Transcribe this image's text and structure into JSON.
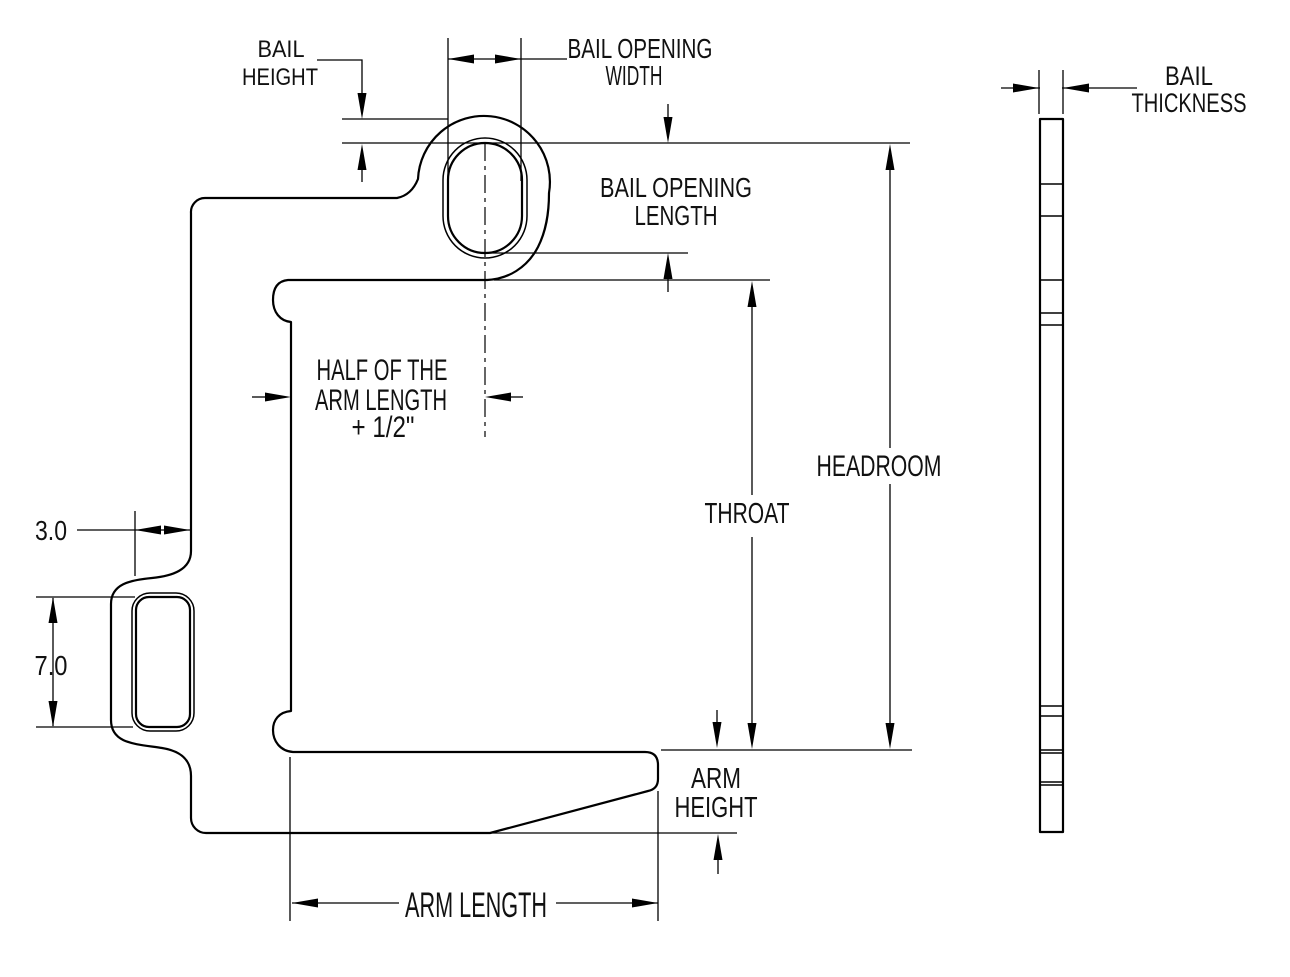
{
  "drawing": {
    "type": "engineering-dimension-diagram",
    "subject": "Coil C-hook lifting device - front profile with bail and fork pocket, plus bail side profile",
    "background": "#ffffff",
    "line_color": "#000000",
    "labels": {
      "bail_height": [
        "BAIL",
        "HEIGHT"
      ],
      "bail_opening_width": [
        "BAIL OPENING",
        "WIDTH"
      ],
      "bail_opening_length": [
        "BAIL OPENING",
        "LENGTH"
      ],
      "half_arm_length": [
        "HALF OF THE",
        "ARM LENGTH",
        "+ 1/2\""
      ],
      "headroom": "HEADROOM",
      "throat": "THROAT",
      "arm_height": [
        "ARM",
        "HEIGHT"
      ],
      "arm_length": "ARM LENGTH",
      "bail_thickness": [
        "BAIL",
        "THICKNESS"
      ]
    },
    "values": {
      "pocket_width": "3.0",
      "pocket_depth": "7.0"
    },
    "side_view": {
      "section_lines_y": [
        184,
        216,
        280,
        313,
        325,
        706,
        716,
        750,
        753,
        782,
        785
      ]
    }
  }
}
